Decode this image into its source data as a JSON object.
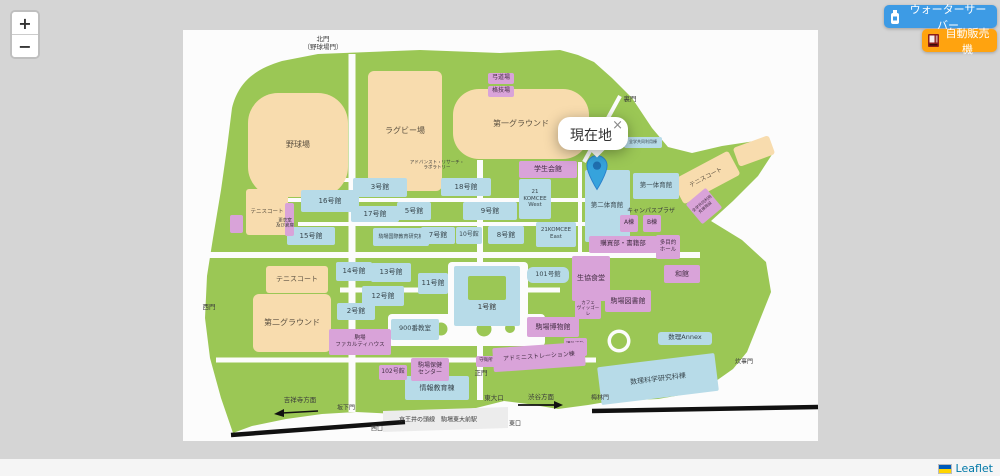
{
  "controls": {
    "zoom_in": "+",
    "zoom_out": "−"
  },
  "overlay_buttons": [
    {
      "id": "water-server",
      "label": "ウォーターサーバー",
      "color": "#3d9be5",
      "icon": "water-bottle-icon"
    },
    {
      "id": "vending-machine",
      "label": "自動販売機",
      "color": "#ffa30f",
      "icon": "vending-machine-icon"
    }
  ],
  "popup": {
    "text": "現在地",
    "close_label": "×"
  },
  "attribution": {
    "label": "Leaflet",
    "flag": "ukraine-flag",
    "flag_colors": [
      "#005BBB",
      "#FFD500"
    ],
    "link_color": "#0078A8"
  },
  "colors": {
    "campus_green": "#9bc755",
    "field_tan": "#f8dcae",
    "classroom_blue": "#b7dbe8",
    "facility_purple": "#d9a3d9",
    "marker_blue": "#36a3dc",
    "railway_black": "#111111"
  },
  "map": {
    "items": [
      {
        "t": "f",
        "label": "野球場",
        "x": 298,
        "y": 145,
        "w": 100,
        "h": 104,
        "fs": 8,
        "br": 30
      },
      {
        "t": "f",
        "label": "ラグビー場",
        "x": 405,
        "y": 131,
        "w": 74,
        "h": 120,
        "fs": 8,
        "br": 6
      },
      {
        "t": "f",
        "label": "第一グラウンド",
        "x": 521,
        "y": 124,
        "w": 136,
        "h": 70,
        "fs": 8,
        "br": 26
      },
      {
        "t": "f",
        "label": "テニスコート",
        "x": 267,
        "y": 212,
        "w": 42,
        "h": 46,
        "fs": 5.5,
        "br": 3
      },
      {
        "t": "f",
        "label": "テニスコート",
        "x": 297,
        "y": 279,
        "w": 62,
        "h": 27,
        "fs": 7,
        "br": 3
      },
      {
        "t": "f",
        "label": "第二グラウンド",
        "x": 292,
        "y": 323,
        "w": 78,
        "h": 58,
        "fs": 8,
        "br": 6
      },
      {
        "t": "f",
        "label": "テニスコート",
        "x": 706,
        "y": 177,
        "w": 64,
        "h": 27,
        "fs": 6,
        "br": 3,
        "rot": -28
      },
      {
        "t": "f",
        "label": "",
        "x": 754,
        "y": 151,
        "w": 38,
        "h": 20,
        "br": 3,
        "rot": -20
      },
      {
        "t": "c",
        "label": "3号館",
        "x": 380,
        "y": 187,
        "w": 54,
        "h": 19,
        "fs": 7
      },
      {
        "t": "c",
        "label": "16号館",
        "x": 330,
        "y": 201,
        "w": 58,
        "h": 22,
        "fs": 7
      },
      {
        "t": "c",
        "label": "17号館",
        "x": 375,
        "y": 214,
        "w": 48,
        "h": 16,
        "fs": 7
      },
      {
        "t": "c",
        "label": "5号館",
        "x": 414,
        "y": 211,
        "w": 34,
        "h": 18,
        "fs": 7
      },
      {
        "t": "c",
        "label": "15号館",
        "x": 311,
        "y": 236,
        "w": 48,
        "h": 18,
        "fs": 7
      },
      {
        "t": "c",
        "label": "駒場国際教育研究棟",
        "x": 401,
        "y": 237,
        "w": 56,
        "h": 18,
        "fs": 5
      },
      {
        "t": "c",
        "label": "18号館",
        "x": 466,
        "y": 187,
        "w": 50,
        "h": 18,
        "fs": 7
      },
      {
        "t": "c",
        "label": "9号館",
        "x": 490,
        "y": 211,
        "w": 54,
        "h": 18,
        "fs": 7
      },
      {
        "t": "c",
        "label": "21\nKOMCEE\nWest",
        "x": 535,
        "y": 199,
        "w": 32,
        "h": 40,
        "fs": 5.5
      },
      {
        "t": "c",
        "label": "7号館",
        "x": 438,
        "y": 235,
        "w": 34,
        "h": 17,
        "fs": 7
      },
      {
        "t": "c",
        "label": "10号館",
        "x": 469,
        "y": 235,
        "w": 26,
        "h": 17,
        "fs": 6
      },
      {
        "t": "c",
        "label": "8号館",
        "x": 506,
        "y": 235,
        "w": 36,
        "h": 18,
        "fs": 7
      },
      {
        "t": "c",
        "label": "21KOMCEE\nEast",
        "x": 556,
        "y": 234,
        "w": 40,
        "h": 25,
        "fs": 5.5
      },
      {
        "t": "c",
        "label": "第二体育館",
        "x": 607,
        "y": 206,
        "w": 45,
        "h": 72,
        "fs": 6.5
      },
      {
        "t": "c",
        "label": "第一体育館",
        "x": 656,
        "y": 186,
        "w": 46,
        "h": 26,
        "fs": 6.5
      },
      {
        "t": "c",
        "label": "全学共同利用棟",
        "x": 643,
        "y": 142,
        "w": 38,
        "h": 11,
        "fs": 4
      },
      {
        "t": "c",
        "label": "101号館",
        "x": 548,
        "y": 275,
        "w": 42,
        "h": 16,
        "fs": 6.5,
        "br": 6
      },
      {
        "t": "c",
        "label": "",
        "x": 487,
        "y": 296,
        "w": 66,
        "h": 60
      },
      {
        "t": "x",
        "label": "",
        "x": 487,
        "y": 288,
        "w": 38,
        "h": 24
      },
      {
        "t": "l",
        "label": "1号館",
        "x": 487,
        "y": 307,
        "fs": 7
      },
      {
        "t": "c",
        "label": "11号館",
        "x": 433,
        "y": 283,
        "w": 30,
        "h": 21,
        "fs": 7
      },
      {
        "t": "c",
        "label": "13号館",
        "x": 391,
        "y": 272,
        "w": 40,
        "h": 19,
        "fs": 7
      },
      {
        "t": "c",
        "label": "14号館",
        "x": 354,
        "y": 271,
        "w": 36,
        "h": 19,
        "fs": 7
      },
      {
        "t": "c",
        "label": "12号館",
        "x": 383,
        "y": 296,
        "w": 42,
        "h": 20,
        "fs": 7
      },
      {
        "t": "c",
        "label": "2号館",
        "x": 356,
        "y": 311,
        "w": 38,
        "h": 17,
        "fs": 7
      },
      {
        "t": "c",
        "label": "900番教室",
        "x": 415,
        "y": 329,
        "w": 48,
        "h": 21,
        "fs": 6.5
      },
      {
        "t": "c",
        "label": "情報教育棟",
        "x": 437,
        "y": 388,
        "w": 64,
        "h": 24,
        "fs": 7
      },
      {
        "t": "c",
        "label": "数理科学研究科棟",
        "x": 658,
        "y": 379,
        "w": 118,
        "h": 38,
        "fs": 7,
        "rot": -7
      },
      {
        "t": "c",
        "label": "数理Annex",
        "x": 685,
        "y": 338,
        "w": 54,
        "h": 13,
        "fs": 6.5,
        "br": 3
      },
      {
        "t": "p",
        "label": "学生会館",
        "x": 548,
        "y": 169,
        "w": 58,
        "h": 17,
        "fs": 7
      },
      {
        "t": "p",
        "label": "弓道場",
        "x": 501,
        "y": 78,
        "w": 26,
        "h": 11,
        "fs": 6
      },
      {
        "t": "p",
        "label": "格技場",
        "x": 501,
        "y": 91,
        "w": 26,
        "h": 11,
        "fs": 6
      },
      {
        "t": "p",
        "label": "",
        "x": 289,
        "y": 219,
        "w": 9,
        "h": 33
      },
      {
        "t": "t",
        "label": "更衣室\n及び倉庫",
        "x": 285,
        "y": 224,
        "fs": 4.5
      },
      {
        "t": "p",
        "label": "A棟",
        "x": 629,
        "y": 223,
        "w": 18,
        "h": 17,
        "fs": 6
      },
      {
        "t": "p",
        "label": "B棟",
        "x": 652,
        "y": 223,
        "w": 18,
        "h": 17,
        "fs": 6
      },
      {
        "t": "p",
        "label": "購買部・書籍部",
        "x": 623,
        "y": 244,
        "w": 68,
        "h": 17,
        "fs": 6.5
      },
      {
        "t": "p",
        "label": "多目的\nホール",
        "x": 668,
        "y": 247,
        "w": 24,
        "h": 24,
        "fs": 5.5
      },
      {
        "t": "p",
        "label": "和館",
        "x": 682,
        "y": 274,
        "w": 36,
        "h": 18,
        "fs": 7
      },
      {
        "t": "p",
        "label": "生協食堂",
        "x": 591,
        "y": 278,
        "w": 38,
        "h": 45,
        "fs": 7
      },
      {
        "t": "p",
        "label": "駒場図書館",
        "x": 628,
        "y": 301,
        "w": 46,
        "h": 22,
        "fs": 7
      },
      {
        "t": "p",
        "label": "カフェ\nヴィッゴーレ",
        "x": 588,
        "y": 309,
        "w": 26,
        "h": 19,
        "fs": 4.5
      },
      {
        "t": "p",
        "label": "駒場博物館",
        "x": 553,
        "y": 327,
        "w": 52,
        "h": 20,
        "fs": 7
      },
      {
        "t": "p",
        "label": "課外活動\nセンター",
        "x": 575,
        "y": 347,
        "w": 23,
        "h": 18,
        "fs": 4.5
      },
      {
        "t": "p",
        "label": "駒場\nファカルティハウス",
        "x": 360,
        "y": 342,
        "w": 62,
        "h": 26,
        "fs": 5.5
      },
      {
        "t": "p",
        "label": "102号館",
        "x": 393,
        "y": 372,
        "w": 28,
        "h": 15,
        "fs": 6
      },
      {
        "t": "p",
        "label": "駒場保健\nセンター",
        "x": 430,
        "y": 369,
        "w": 38,
        "h": 23,
        "fs": 6
      },
      {
        "t": "p",
        "label": "アドミニストレーション棟",
        "x": 539,
        "y": 357,
        "w": 92,
        "h": 24,
        "fs": 6,
        "rot": -4
      },
      {
        "t": "p",
        "label": "守衛所",
        "x": 486,
        "y": 361,
        "w": 20,
        "h": 11,
        "fs": 4.5
      },
      {
        "t": "p",
        "label": "全学共同利用\n支援施設",
        "x": 704,
        "y": 206,
        "w": 26,
        "h": 26,
        "fs": 4,
        "rot": -40
      },
      {
        "t": "p",
        "label": "",
        "x": 236,
        "y": 224,
        "w": 13,
        "h": 18
      },
      {
        "t": "l",
        "label": "北門\n（野球場門）",
        "x": 323,
        "y": 44,
        "fs": 6.5
      },
      {
        "t": "l",
        "label": "裏門",
        "x": 630,
        "y": 100,
        "fs": 6.5
      },
      {
        "t": "l",
        "label": "西門",
        "x": 209,
        "y": 308,
        "fs": 6.5
      },
      {
        "t": "l",
        "label": "正門",
        "x": 481,
        "y": 374,
        "fs": 6.5
      },
      {
        "t": "l",
        "label": "東大口",
        "x": 494,
        "y": 399,
        "fs": 6.5
      },
      {
        "t": "l",
        "label": "渋谷方面",
        "x": 541,
        "y": 398,
        "fs": 6.5
      },
      {
        "t": "l",
        "label": "吉祥寺方面",
        "x": 300,
        "y": 401,
        "fs": 6.5
      },
      {
        "t": "l",
        "label": "坂下門",
        "x": 346,
        "y": 408,
        "fs": 6
      },
      {
        "t": "l",
        "label": "梅林門",
        "x": 600,
        "y": 398,
        "fs": 6
      },
      {
        "t": "l",
        "label": "炊事門",
        "x": 744,
        "y": 362,
        "fs": 6
      },
      {
        "t": "l",
        "label": "キャンパスプラザ",
        "x": 651,
        "y": 211,
        "fs": 6
      },
      {
        "t": "t",
        "label": "アドバンスト・リサーチ・\nラボラトリー",
        "x": 437,
        "y": 166,
        "fs": 4.5
      },
      {
        "t": "l",
        "label": "京王井の頭線　駒場東大前駅",
        "x": 438,
        "y": 420,
        "fs": 6
      },
      {
        "t": "l",
        "label": "西口",
        "x": 377,
        "y": 429,
        "fs": 6
      },
      {
        "t": "l",
        "label": "東口",
        "x": 515,
        "y": 424,
        "fs": 6
      }
    ]
  }
}
